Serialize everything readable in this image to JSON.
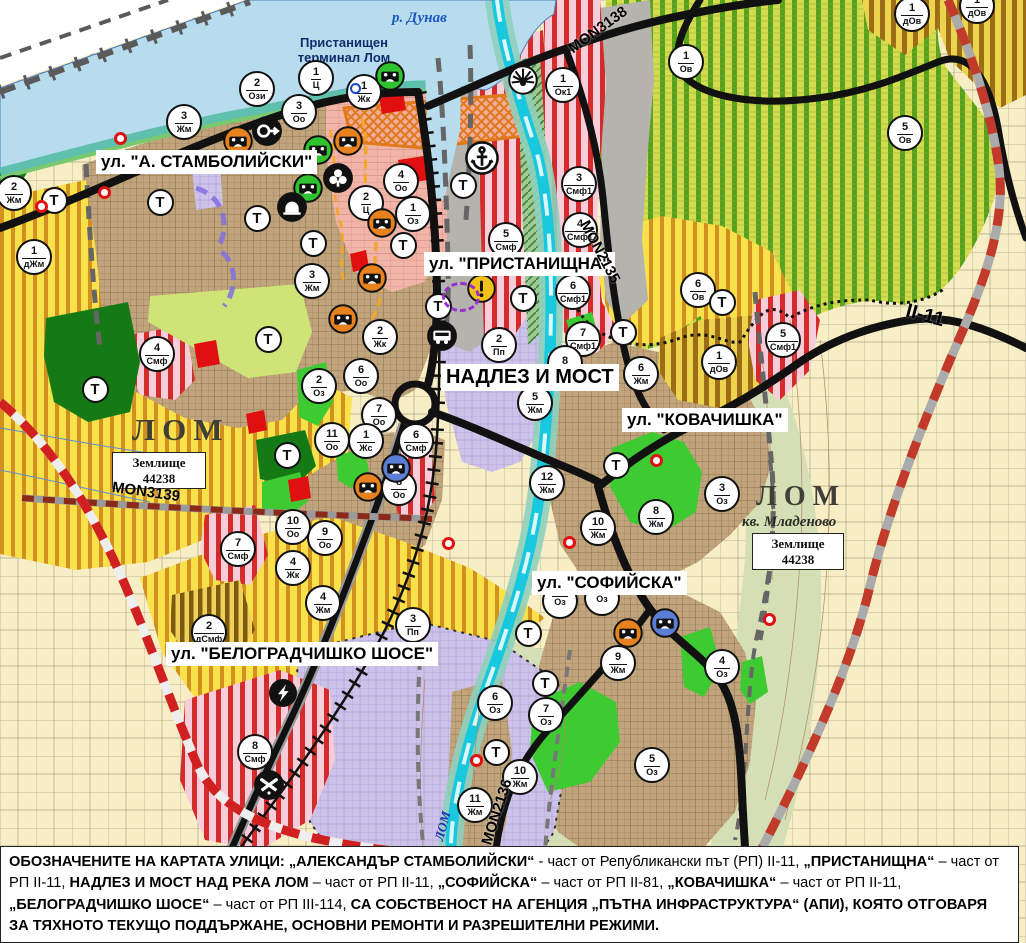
{
  "palette": {
    "agricultural": "#f8eec6",
    "danube_water": "#b7dcee",
    "shore_teal": "#5fc0ae",
    "orchard_green_zone": "#d2dc4e",
    "orchard_stripe": "#55a21c",
    "yellow_zone": "#f8e14b",
    "yellow_stripe": "#d2901e",
    "brown_stripe": "#9c6d14",
    "pink_zone": "#f8ccd8",
    "red_stripe": "#d42b2b",
    "town_tan": "#c2a47c",
    "lavender_zone": "#cdc2e9",
    "salmon_zone": "#f2b4a6",
    "park_dark_green": "#157a15",
    "landscaped_green": "#3ecb32",
    "light_green": "#cfe477",
    "red_patch": "#e01010",
    "road_black": "#111111",
    "road_red_dash": "#d02020",
    "river_cyan": "#17c8de",
    "valley_green": "#d5dfb6",
    "port_gray": "#b5b3ae",
    "terminal_orange": "#e0791a",
    "warning_yellow": "#f2c21b"
  },
  "map": {
    "place_labels": {
      "river_danube": "р. Дунав",
      "port_terminal_line1": "Пристанищен",
      "port_terminal_line2": "терминал Лом",
      "city_left": "ЛОМ",
      "city_right": "ЛОМ",
      "district_right": "кв. Младеново",
      "landplot_line1": "Землище",
      "landplot_line2": "44238",
      "river_lom": "ЛОМ"
    },
    "street_labels": [
      {
        "text": "ул. \"А. СТАМБОЛИЙСКИ\"",
        "x": 96,
        "y": 150,
        "size": 17
      },
      {
        "text": "ул. \"ПРИСТАНИЩНА\"",
        "x": 424,
        "y": 252,
        "size": 17
      },
      {
        "text": "НАДЛЕЗ И МОСТ",
        "x": 441,
        "y": 364,
        "size": 20
      },
      {
        "text": "ул. \"КОВАЧИШКА\"",
        "x": 622,
        "y": 408,
        "size": 17
      },
      {
        "text": "ул. \"СОФИЙСКА\"",
        "x": 532,
        "y": 571,
        "size": 17
      },
      {
        "text": "ул. \"БЕЛОГРАДЧИШКО ШОСЕ\"",
        "x": 166,
        "y": 642,
        "size": 17
      }
    ],
    "road_labels": [
      {
        "text": "MON3138",
        "x": 598,
        "y": 30,
        "rot": -36,
        "size": 15
      },
      {
        "text": "MON2135",
        "x": 600,
        "y": 252,
        "rot": 62,
        "size": 15
      },
      {
        "text": "II-11",
        "x": 925,
        "y": 316,
        "rot": 15,
        "size": 20
      },
      {
        "text": "MON3139",
        "x": 146,
        "y": 492,
        "rot": 8,
        "size": 15
      },
      {
        "text": "MON2136",
        "x": 497,
        "y": 812,
        "rot": -72,
        "size": 15
      }
    ],
    "t_label": "Т",
    "t_markers": [
      {
        "x": 54,
        "y": 200
      },
      {
        "x": 160,
        "y": 202
      },
      {
        "x": 257,
        "y": 218
      },
      {
        "x": 313,
        "y": 243
      },
      {
        "x": 403,
        "y": 245
      },
      {
        "x": 438,
        "y": 306
      },
      {
        "x": 463,
        "y": 185
      },
      {
        "x": 523,
        "y": 298
      },
      {
        "x": 95,
        "y": 389
      },
      {
        "x": 268,
        "y": 339
      },
      {
        "x": 287,
        "y": 455
      },
      {
        "x": 623,
        "y": 332
      },
      {
        "x": 616,
        "y": 465
      },
      {
        "x": 722,
        "y": 302
      },
      {
        "x": 528,
        "y": 633
      },
      {
        "x": 545,
        "y": 683
      },
      {
        "x": 496,
        "y": 752
      }
    ],
    "zone_markers": [
      {
        "x": 257,
        "y": 89,
        "n": "2",
        "d": "Ози"
      },
      {
        "x": 316,
        "y": 78,
        "n": "1",
        "d": "Ц"
      },
      {
        "x": 364,
        "y": 92,
        "n": "1",
        "d": "Жк"
      },
      {
        "x": 299,
        "y": 112,
        "n": "3",
        "d": "Оо"
      },
      {
        "x": 184,
        "y": 122,
        "n": "3",
        "d": "Жм"
      },
      {
        "x": 14,
        "y": 193,
        "n": "2",
        "d": "Жм"
      },
      {
        "x": 34,
        "y": 257,
        "n": "1",
        "d": "дЖм"
      },
      {
        "x": 401,
        "y": 181,
        "n": "4",
        "d": "Оо"
      },
      {
        "x": 366,
        "y": 203,
        "n": "2",
        "d": "Ц"
      },
      {
        "x": 413,
        "y": 214,
        "n": "1",
        "d": "Оз"
      },
      {
        "x": 563,
        "y": 85,
        "n": "1",
        "d": "Ок1"
      },
      {
        "x": 579,
        "y": 184,
        "n": "3",
        "d": "Смф1"
      },
      {
        "x": 580,
        "y": 230,
        "n": "4",
        "d": "Смф1"
      },
      {
        "x": 506,
        "y": 240,
        "n": "5",
        "d": "Смф"
      },
      {
        "x": 573,
        "y": 292,
        "n": "6",
        "d": "Смф1"
      },
      {
        "x": 583,
        "y": 339,
        "n": "7",
        "d": "Смф1"
      },
      {
        "x": 565,
        "y": 363,
        "n": "8",
        "d": ""
      },
      {
        "x": 686,
        "y": 62,
        "n": "1",
        "d": "Ов"
      },
      {
        "x": 905,
        "y": 133,
        "n": "5",
        "d": "Ов"
      },
      {
        "x": 912,
        "y": 14,
        "n": "1",
        "d": "дОв"
      },
      {
        "x": 977,
        "y": 6,
        "n": "1",
        "d": "дОв"
      },
      {
        "x": 698,
        "y": 290,
        "n": "6",
        "d": "Ов"
      },
      {
        "x": 719,
        "y": 362,
        "n": "1",
        "d": "дОв"
      },
      {
        "x": 783,
        "y": 340,
        "n": "5",
        "d": "Смф1"
      },
      {
        "x": 641,
        "y": 374,
        "n": "6",
        "d": "Жм"
      },
      {
        "x": 535,
        "y": 403,
        "n": "5",
        "d": "Жм"
      },
      {
        "x": 499,
        "y": 345,
        "n": "2",
        "d": "Пп"
      },
      {
        "x": 547,
        "y": 483,
        "n": "12",
        "d": "Жм"
      },
      {
        "x": 722,
        "y": 494,
        "n": "3",
        "d": "Оз"
      },
      {
        "x": 656,
        "y": 517,
        "n": "8",
        "d": "Жм"
      },
      {
        "x": 598,
        "y": 528,
        "n": "10",
        "d": "Жм"
      },
      {
        "x": 325,
        "y": 538,
        "n": "9",
        "d": "Оо"
      },
      {
        "x": 293,
        "y": 527,
        "n": "10",
        "d": "Оо"
      },
      {
        "x": 293,
        "y": 568,
        "n": "4",
        "d": "Жк"
      },
      {
        "x": 238,
        "y": 549,
        "n": "7",
        "d": "Смф"
      },
      {
        "x": 332,
        "y": 440,
        "n": "11",
        "d": "Оо"
      },
      {
        "x": 319,
        "y": 386,
        "n": "2",
        "d": "Оз"
      },
      {
        "x": 361,
        "y": 376,
        "n": "6",
        "d": "Оо"
      },
      {
        "x": 379,
        "y": 415,
        "n": "7",
        "d": "Оо"
      },
      {
        "x": 380,
        "y": 337,
        "n": "2",
        "d": "Жк"
      },
      {
        "x": 366,
        "y": 441,
        "n": "1",
        "d": "Жс"
      },
      {
        "x": 416,
        "y": 441,
        "n": "6",
        "d": "Смф"
      },
      {
        "x": 399,
        "y": 488,
        "n": "8",
        "d": "Оо"
      },
      {
        "x": 312,
        "y": 281,
        "n": "3",
        "d": "Жм"
      },
      {
        "x": 157,
        "y": 354,
        "n": "4",
        "d": "Смф"
      },
      {
        "x": 323,
        "y": 603,
        "n": "4",
        "d": "Жм"
      },
      {
        "x": 413,
        "y": 625,
        "n": "3",
        "d": "Пп"
      },
      {
        "x": 209,
        "y": 632,
        "n": "2",
        "d": "дСмф"
      },
      {
        "x": 255,
        "y": 752,
        "n": "8",
        "d": "Смф"
      },
      {
        "x": 495,
        "y": 703,
        "n": "6",
        "d": "Оз"
      },
      {
        "x": 520,
        "y": 777,
        "n": "10",
        "d": "Жм"
      },
      {
        "x": 475,
        "y": 805,
        "n": "11",
        "d": "Жм"
      },
      {
        "x": 618,
        "y": 663,
        "n": "9",
        "d": "Жм"
      },
      {
        "x": 722,
        "y": 667,
        "n": "4",
        "d": "Оз"
      },
      {
        "x": 652,
        "y": 765,
        "n": "5",
        "d": "Оз"
      },
      {
        "x": 546,
        "y": 715,
        "n": "7",
        "d": "Оз"
      },
      {
        "x": 560,
        "y": 601,
        "n": "",
        "d": "Оз"
      },
      {
        "x": 602,
        "y": 598,
        "n": "",
        "d": "Оз"
      }
    ],
    "icons": [
      {
        "name": "culture-monument-icon",
        "x": 238,
        "y": 141
      },
      {
        "name": "culture-monument-icon",
        "x": 348,
        "y": 141
      },
      {
        "name": "culture-monument-icon",
        "x": 382,
        "y": 223
      },
      {
        "name": "culture-monument-icon",
        "x": 372,
        "y": 278
      },
      {
        "name": "culture-monument-icon",
        "x": 343,
        "y": 319
      },
      {
        "name": "culture-monument-icon",
        "x": 368,
        "y": 487
      },
      {
        "name": "culture-monument-icon",
        "x": 628,
        "y": 633
      },
      {
        "name": "culture-monument-green-icon",
        "x": 390,
        "y": 76
      },
      {
        "name": "culture-monument-green-icon",
        "x": 318,
        "y": 150
      },
      {
        "name": "culture-monument-green-icon",
        "x": 308,
        "y": 188
      },
      {
        "name": "culture-monument-blue-icon",
        "x": 396,
        "y": 468
      },
      {
        "name": "culture-monument-blue-icon",
        "x": 665,
        "y": 623
      },
      {
        "name": "gate-icon",
        "x": 267,
        "y": 131
      },
      {
        "name": "club-icon",
        "x": 338,
        "y": 178
      },
      {
        "name": "arch-icon",
        "x": 292,
        "y": 207
      },
      {
        "name": "bus-station-icon",
        "x": 442,
        "y": 336
      },
      {
        "name": "power-station-icon",
        "x": 283,
        "y": 693
      },
      {
        "name": "rail-crossing-icon",
        "x": 269,
        "y": 785
      },
      {
        "name": "sun-icon",
        "x": 523,
        "y": 80
      },
      {
        "name": "anchor-icon",
        "x": 482,
        "y": 158
      },
      {
        "name": "warning-icon",
        "x": 482,
        "y": 289
      },
      {
        "name": "blue-ring-marker",
        "x": 355,
        "y": 88
      },
      {
        "name": "purple-zone-icon",
        "x": 461,
        "y": 297
      },
      {
        "name": "red-ring-marker",
        "x": 120,
        "y": 138
      },
      {
        "name": "red-ring-marker",
        "x": 104,
        "y": 192
      },
      {
        "name": "red-ring-marker",
        "x": 41,
        "y": 206
      },
      {
        "name": "red-ring-marker",
        "x": 448,
        "y": 543
      },
      {
        "name": "red-ring-marker",
        "x": 569,
        "y": 542
      },
      {
        "name": "red-ring-marker",
        "x": 656,
        "y": 460
      },
      {
        "name": "red-ring-marker",
        "x": 769,
        "y": 619
      },
      {
        "name": "red-ring-marker",
        "x": 476,
        "y": 760
      }
    ]
  },
  "footer": {
    "segments": [
      {
        "t": "ОБОЗНАЧЕНИТЕ НА КАРТАТА УЛИЦИ: „АЛЕКСАНДЪР СТАМБОЛИЙСКИ“",
        "b": true
      },
      {
        "t": " - част от Републикански път (РП) II-11, ",
        "b": false
      },
      {
        "t": "„ПРИСТАНИЩНА“",
        "b": true
      },
      {
        "t": " – част от РП II-11, ",
        "b": false
      },
      {
        "t": "НАДЛЕЗ И МОСТ НАД РЕКА ЛОМ",
        "b": true
      },
      {
        "t": " – част от РП II-11, ",
        "b": false
      },
      {
        "t": "„СОФИЙСКА“",
        "b": true
      },
      {
        "t": " – част от РП II-81, ",
        "b": false
      },
      {
        "t": "„КОВАЧИШКА“",
        "b": true
      },
      {
        "t": " – част от РП II-11, ",
        "b": false
      },
      {
        "t": "„БЕЛОГРАДЧИШКО ШОСЕ“",
        "b": true
      },
      {
        "t": " – част от РП III-114, ",
        "b": false
      },
      {
        "t": "СА СОБСТВЕНОСТ НА АГЕНЦИЯ „ПЪТНА ИНФРАСТРУКТУРА“ (АПИ), КОЯТО ОТГОВАРЯ ЗА ТЯХНОТО ТЕКУЩО ПОДДЪРЖАНЕ, ОСНОВНИ РЕМОНТИ И РАЗРЕШИТЕЛНИ РЕЖИМИ.",
        "b": true
      }
    ]
  }
}
